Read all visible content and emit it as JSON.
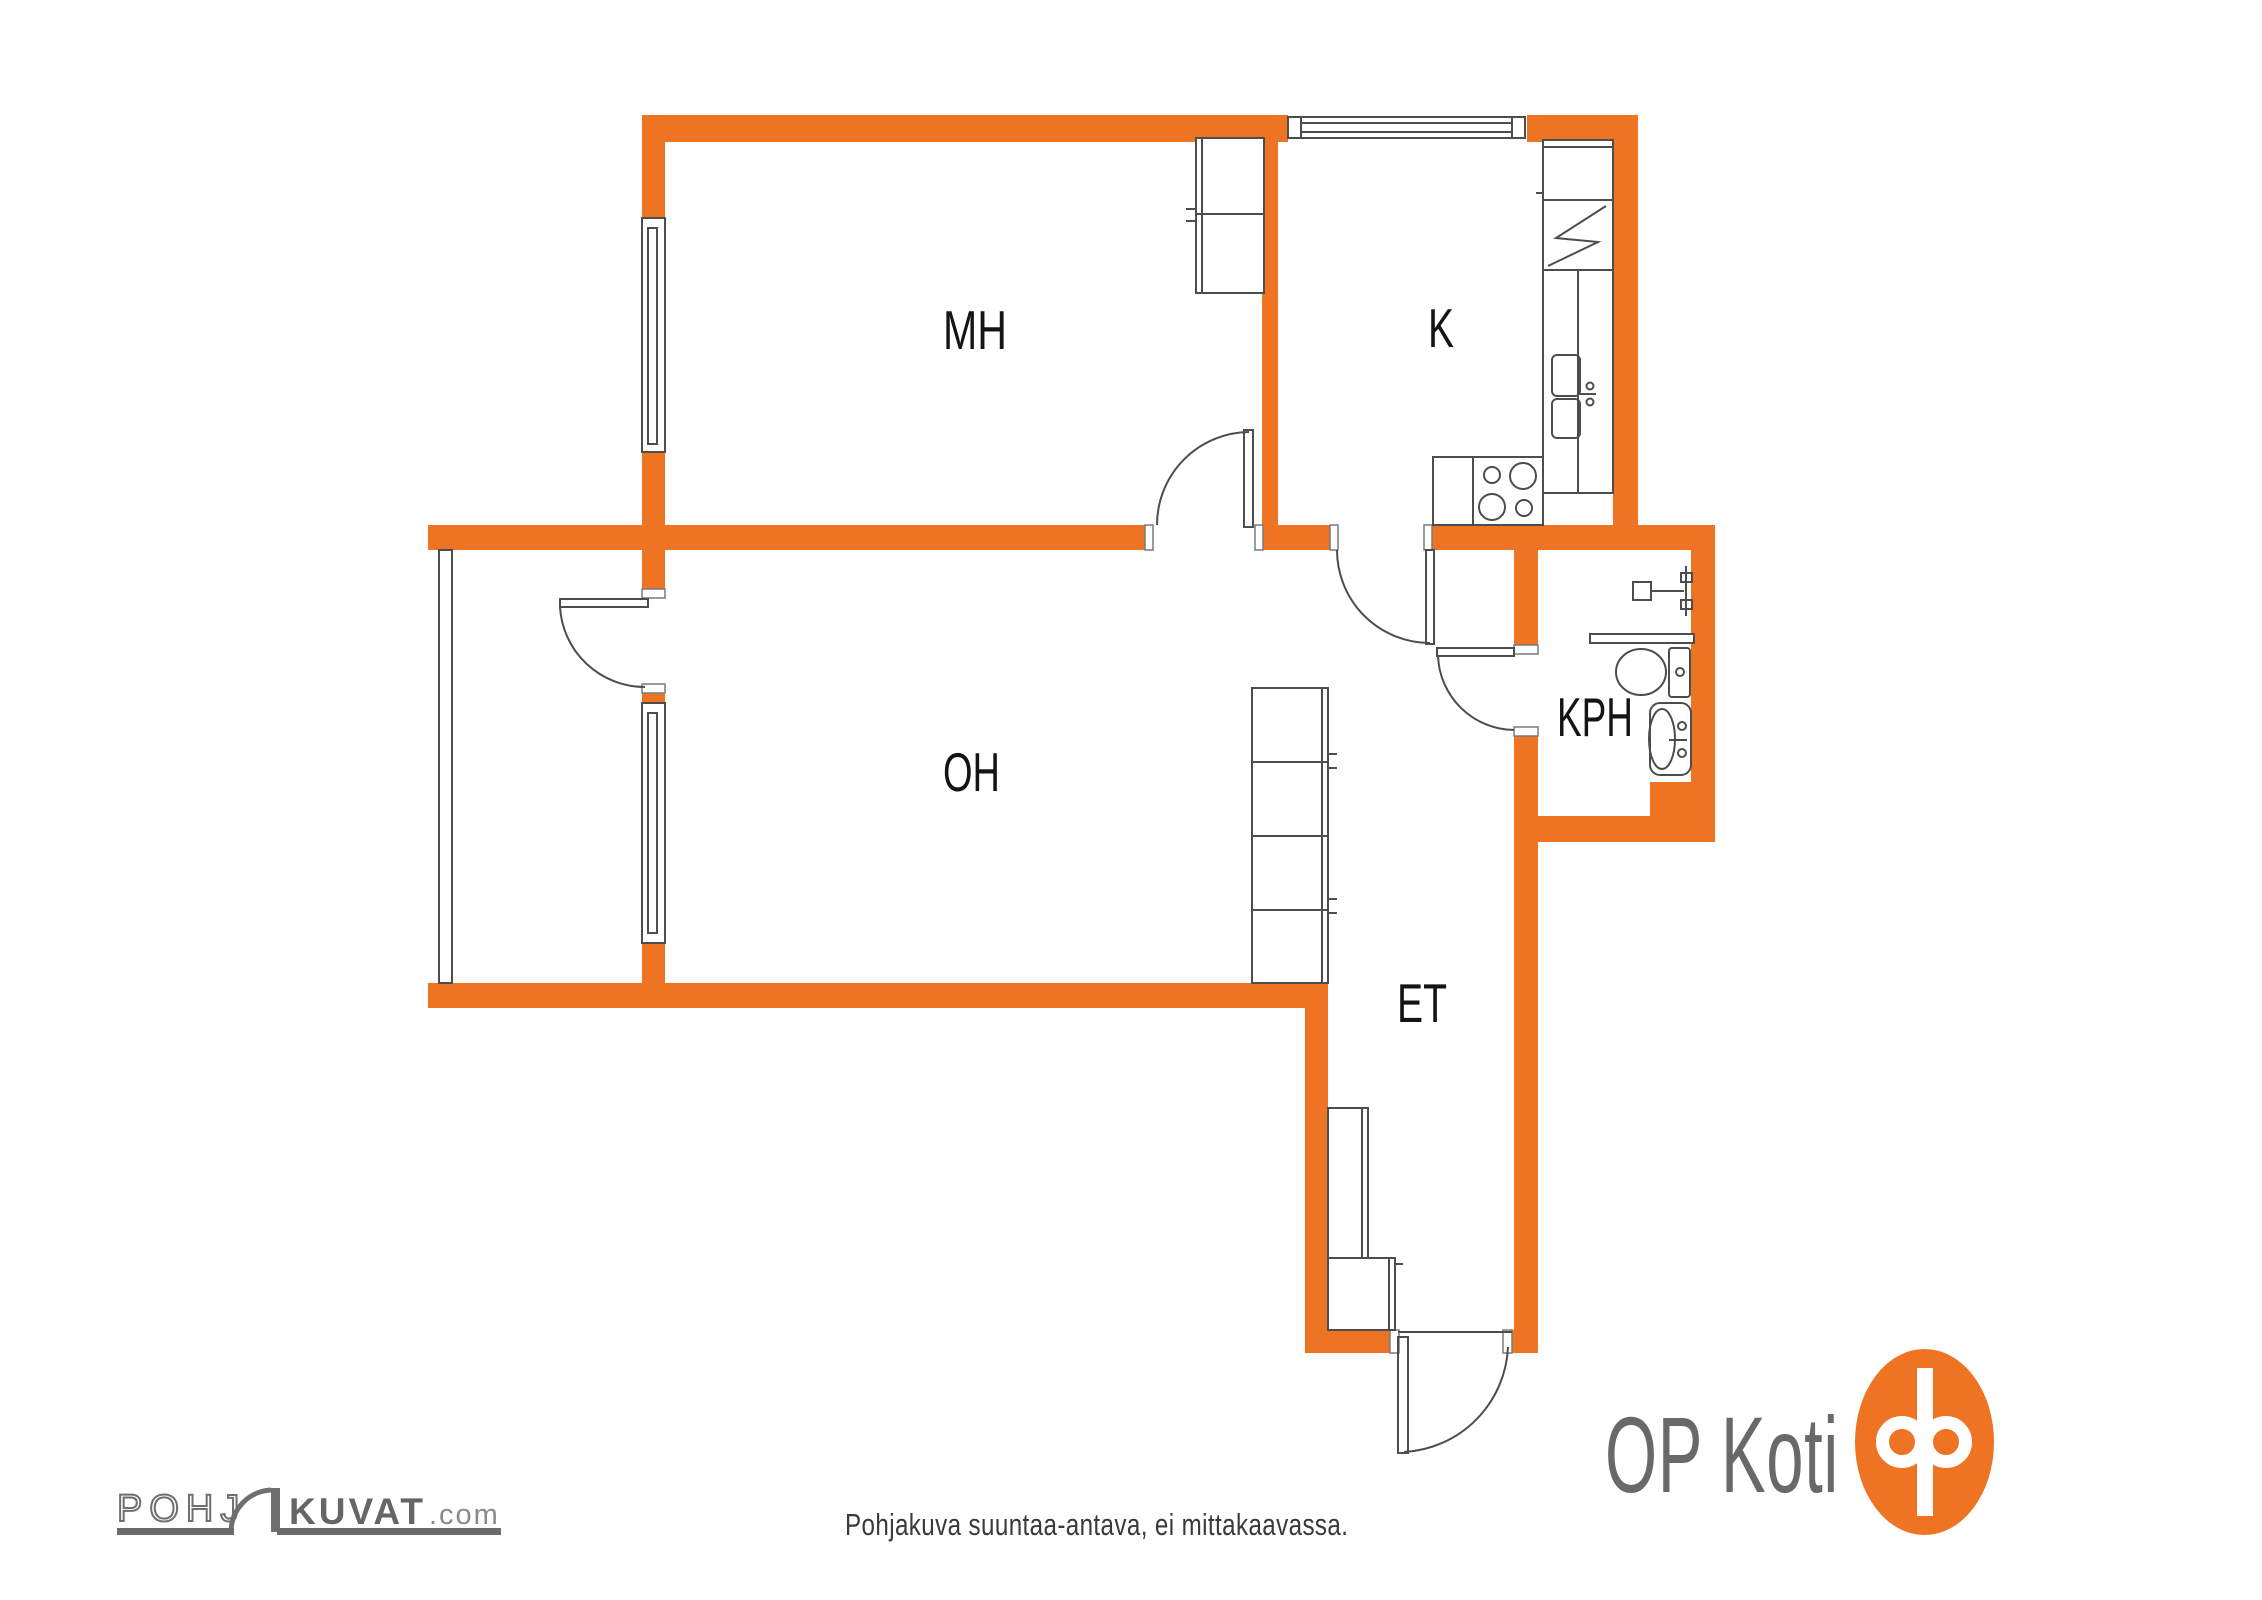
{
  "plan": {
    "rooms": [
      {
        "id": "mh",
        "label": "MH"
      },
      {
        "id": "k",
        "label": "K"
      },
      {
        "id": "oh",
        "label": "OH"
      },
      {
        "id": "kph",
        "label": "KPH"
      },
      {
        "id": "et",
        "label": "ET"
      }
    ],
    "colors": {
      "wall_orange": "#EE7322",
      "fixture_gray": "#4d4d4d",
      "label_black": "#141414"
    }
  },
  "footer": {
    "disclaimer": "Pohjakuva suuntaa-antava, ei mittakaavassa.",
    "pohjakuvat": {
      "outline_part": "POHJ",
      "solid_part": "KUVAT",
      "suffix": ".com"
    },
    "opkoti": {
      "wordmark": "OP Koti"
    }
  }
}
